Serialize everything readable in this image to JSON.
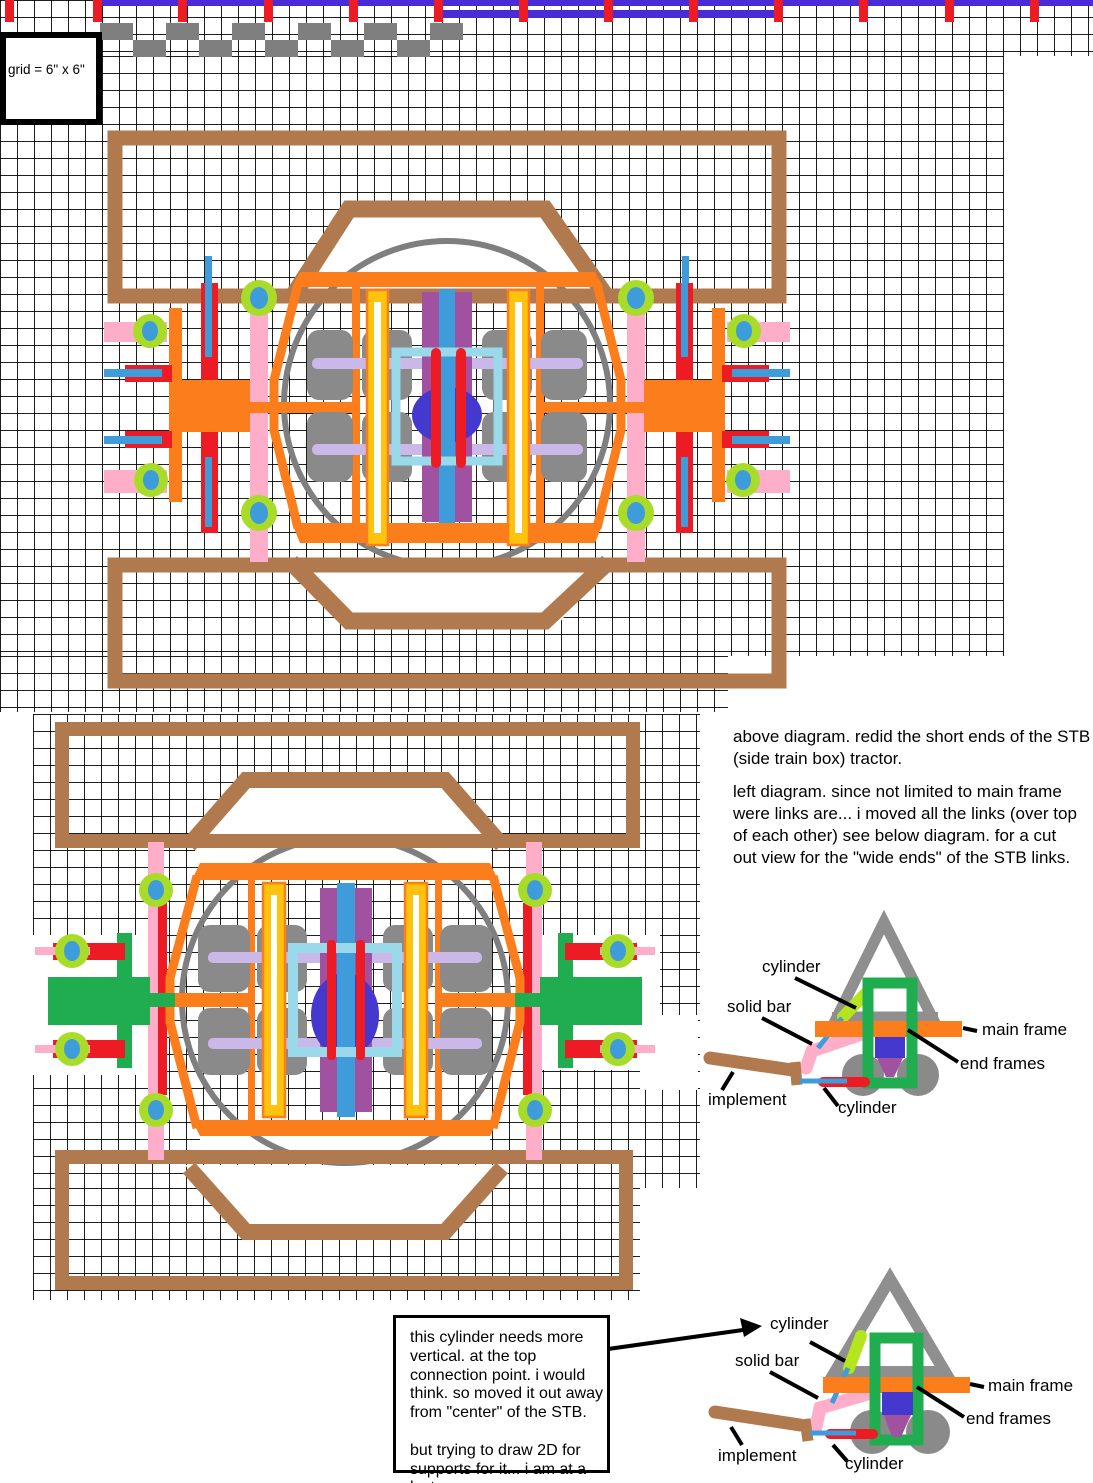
{
  "grid_box": {
    "label": "grid = 6\" x 6\""
  },
  "notes": {
    "above": "above diagram. redid the short ends of the STB\n(side train box) tractor.",
    "left": "left diagram. since not limited to main frame\nwere links are... i moved all the links (over top\nof each other)      see below diagram. for a cut\nout view for the \"wide ends\" of the STB links."
  },
  "callout": {
    "text": "this cylinder needs more\nvertical. at the top\nconnection point. i would\nthink.  so moved it out away\nfrom \"center\" of the STB.\n\nbut trying to draw 2D for\nsupports for it... i am at a lost"
  },
  "side_view_top": {
    "cylinder_top": "cylinder",
    "solid_bar": "solid bar",
    "implement": "implement",
    "cylinder_bottom": "cylinder",
    "main_frame": "main frame",
    "end_frames": "end frames"
  },
  "side_view_bottom": {
    "cylinder_top": "cylinder",
    "solid_bar": "solid bar",
    "implement": "implement",
    "cylinder_bottom": "cylinder",
    "main_frame": "main frame",
    "end_frames": "end frames"
  },
  "ruler": {
    "tick_xs": [
      5,
      93,
      178,
      264,
      349,
      434,
      519,
      604,
      689,
      774,
      859,
      945,
      1030
    ],
    "step_row1_xs": [
      100,
      166,
      232,
      298,
      364,
      430
    ],
    "step_row2_xs": [
      133,
      199,
      265,
      331,
      397
    ]
  },
  "colors": {
    "grid_line": "#000000",
    "ruler_violet": "#4A2BD8",
    "tick_red": "#ED1C24",
    "step_gray": "#7F7F7F",
    "frame_brown": "#B17A4E",
    "hex_orange": "#FB7D1B",
    "link_pink": "#FFAEC9",
    "bar_red": "#ED1C24",
    "hub_ring_lime": "#A8DC28",
    "hub_blue": "#3E9CDB",
    "end_green": "#1FAD4F",
    "wheel_gray": "#8A8A8A",
    "circle_gray": "#7F7F7F",
    "gold_yellow": "#FFC20D",
    "band_purple": "#A0519F",
    "center_blue": "#3E9CDB",
    "royal_blue": "#4438CF",
    "axle_lavender": "#C9B8E8",
    "frame_lightblue": "#99D9EA",
    "cylinder_chartreuse": "#B5E61D",
    "triangle_gray": "#8F8F8F",
    "implement_brown": "#B17A4E"
  }
}
